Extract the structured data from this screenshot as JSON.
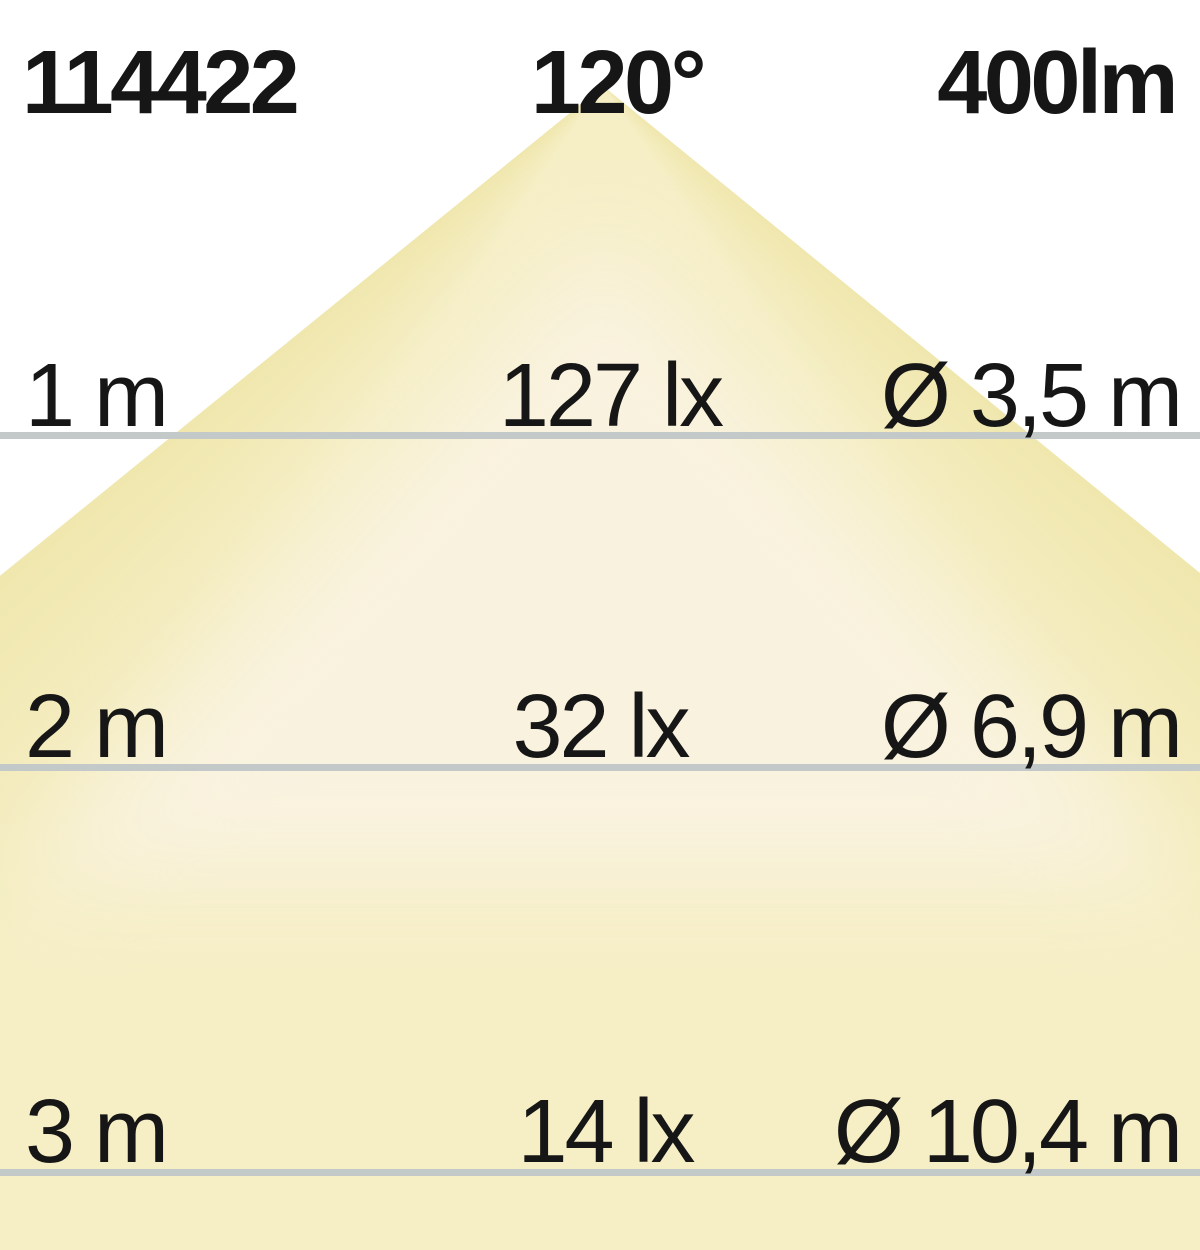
{
  "header": {
    "article_number": "114422",
    "beam_angle": "120°",
    "luminous_flux": "400lm"
  },
  "rows": [
    {
      "distance": "1 m",
      "illuminance": "127 lx",
      "diameter": "Ø 3,5 m"
    },
    {
      "distance": "2 m",
      "illuminance": "32 lx",
      "diameter": "Ø 6,9 m"
    },
    {
      "distance": "3 m",
      "illuminance": "14 lx",
      "diameter": "Ø 10,4 m"
    }
  ],
  "colors": {
    "background": "#ffffff",
    "beam_yellow": "#f6efc6",
    "beam_edge_yellow": "#efe6ab",
    "beam_center_cream": "#f9f2df",
    "distance_line_gray": "#c3c9c9",
    "text": "#161616"
  }
}
